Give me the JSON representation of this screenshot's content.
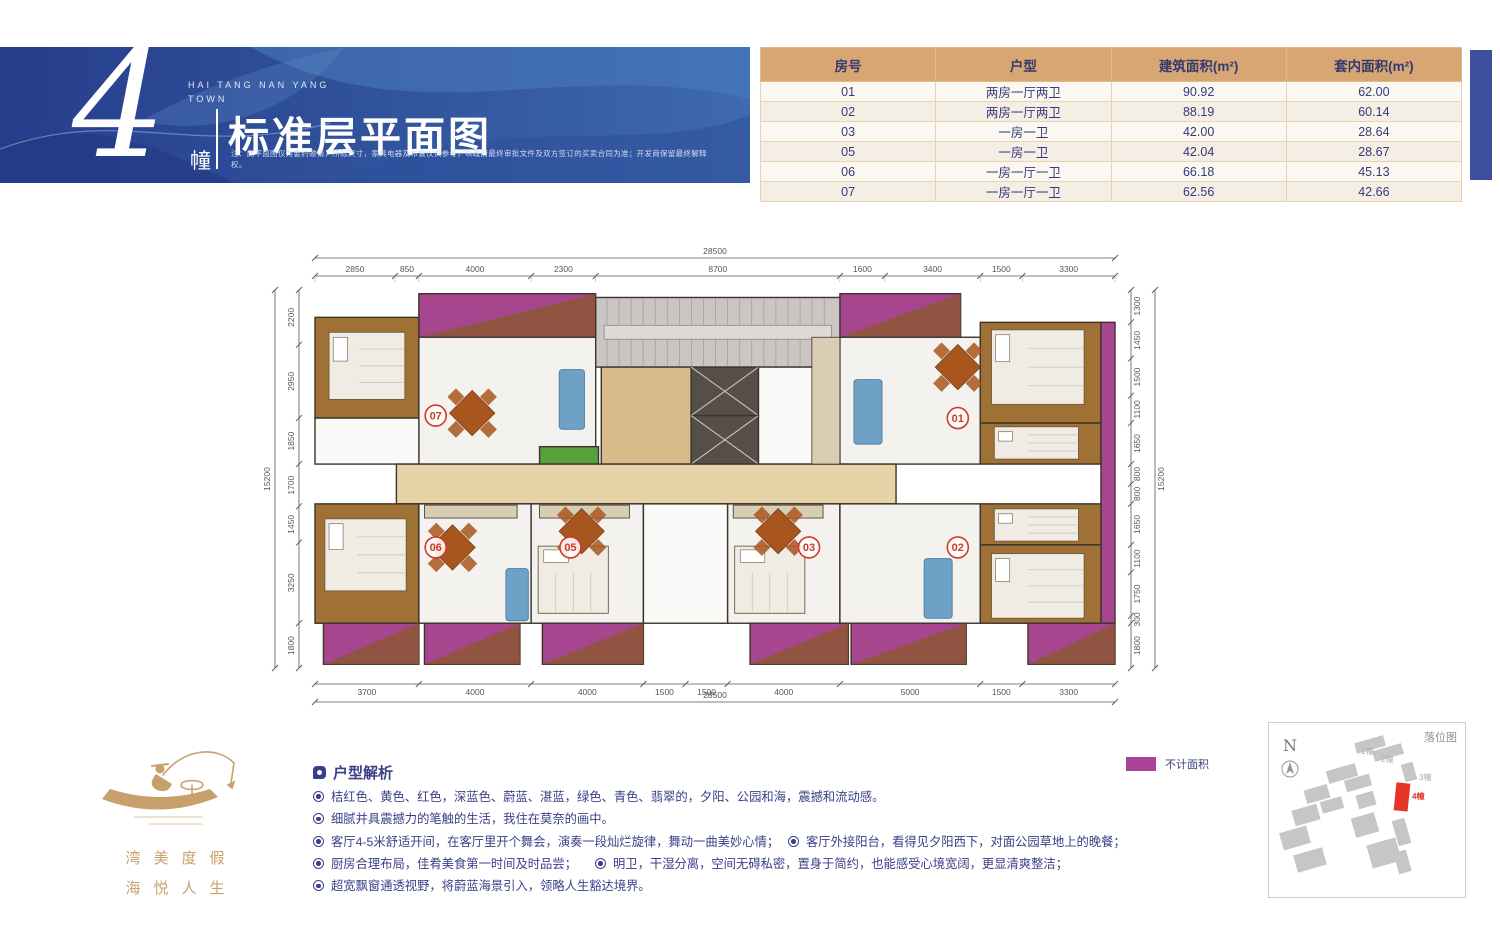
{
  "banner": {
    "building_number": "4",
    "building_unit": "幢",
    "project_name": "HAI TANG NAN YANG\nTOWN",
    "title": "标准层平面图",
    "disclaimer": "注：此平面图仅为要约邀请，所标尺寸，家具电器及布置仅供参考，以政府最终审批文件及双方签订的买卖合同为准；开发商保留最终解释权。"
  },
  "table": {
    "columns": [
      "房号",
      "户型",
      "建筑面积(m²)",
      "套内面积(m²)"
    ],
    "rows": [
      [
        "01",
        "两房一厅两卫",
        "90.92",
        "62.00"
      ],
      [
        "02",
        "两房一厅两卫",
        "88.19",
        "60.14"
      ],
      [
        "03",
        "一房一卫",
        "42.00",
        "28.64"
      ],
      [
        "05",
        "一房一卫",
        "42.04",
        "28.67"
      ],
      [
        "06",
        "一房一厅一卫",
        "66.18",
        "45.13"
      ],
      [
        "07",
        "一房一厅一卫",
        "62.56",
        "42.66"
      ]
    ]
  },
  "plan": {
    "overall_width_label": "28500",
    "overall_height_label": "15200",
    "dims_top": [
      2850,
      850,
      4000,
      2300,
      8700,
      1600,
      3400,
      1500,
      3300
    ],
    "dims_bottom": [
      3700,
      4000,
      4000,
      1500,
      1500,
      4000,
      5000,
      1500,
      3300
    ],
    "dims_left": [
      2200,
      2950,
      1850,
      1700,
      1450,
      3250,
      1800
    ],
    "dims_right": [
      1300,
      1450,
      1500,
      1100,
      1650,
      800,
      800,
      1650,
      1100,
      1750,
      300,
      1800
    ],
    "unit_labels": [
      {
        "id": "07",
        "x": 4300,
        "y": 5050
      },
      {
        "id": "01",
        "x": 22900,
        "y": 5150
      },
      {
        "id": "06",
        "x": 4300,
        "y": 10350
      },
      {
        "id": "05",
        "x": 9100,
        "y": 10350
      },
      {
        "id": "03",
        "x": 17600,
        "y": 10350
      },
      {
        "id": "02",
        "x": 22900,
        "y": 10350
      }
    ],
    "rooms": [
      {
        "x": 3700,
        "y": 150,
        "w": 6300,
        "h": 1750,
        "t": "balcony"
      },
      {
        "x": 18700,
        "y": 150,
        "w": 4300,
        "h": 1750,
        "t": "balcony"
      },
      {
        "x": 0,
        "y": 1100,
        "w": 3700,
        "h": 4050,
        "t": "bedroom"
      },
      {
        "x": 3700,
        "y": 1900,
        "w": 6300,
        "h": 5100,
        "t": "living"
      },
      {
        "x": 0,
        "y": 5150,
        "w": 3700,
        "h": 1850,
        "t": "bath"
      },
      {
        "x": 10000,
        "y": 300,
        "w": 8700,
        "h": 2800,
        "t": "stairs"
      },
      {
        "x": 10200,
        "y": 3100,
        "w": 3200,
        "h": 3900,
        "t": "lobby"
      },
      {
        "x": 13400,
        "y": 3100,
        "w": 2400,
        "h": 1950,
        "t": "elevator"
      },
      {
        "x": 13400,
        "y": 5050,
        "w": 2400,
        "h": 1950,
        "t": "elevator"
      },
      {
        "x": 15800,
        "y": 3100,
        "w": 2900,
        "h": 3900,
        "t": "bath"
      },
      {
        "x": 18700,
        "y": 1900,
        "w": 5000,
        "h": 5100,
        "t": "living"
      },
      {
        "x": 23700,
        "y": 1300,
        "w": 4300,
        "h": 4050,
        "t": "bedroom"
      },
      {
        "x": 23700,
        "y": 5350,
        "w": 4300,
        "h": 1650,
        "t": "bedroom"
      },
      {
        "x": 28000,
        "y": 1300,
        "w": 500,
        "h": 12100,
        "t": "balcony"
      },
      {
        "x": 8000,
        "y": 6300,
        "w": 2100,
        "h": 700,
        "t": "planter"
      },
      {
        "x": 2900,
        "y": 7000,
        "w": 17800,
        "h": 1600,
        "t": "corridor"
      },
      {
        "x": 0,
        "y": 8600,
        "w": 3700,
        "h": 4800,
        "t": "bedroom"
      },
      {
        "x": 3700,
        "y": 8600,
        "w": 4000,
        "h": 4800,
        "t": "living"
      },
      {
        "x": 7700,
        "y": 8600,
        "w": 4000,
        "h": 4800,
        "t": "living"
      },
      {
        "x": 11700,
        "y": 8600,
        "w": 3000,
        "h": 4800,
        "t": "bath"
      },
      {
        "x": 14700,
        "y": 8600,
        "w": 4000,
        "h": 4800,
        "t": "living"
      },
      {
        "x": 18700,
        "y": 8600,
        "w": 5000,
        "h": 4800,
        "t": "living"
      },
      {
        "x": 23700,
        "y": 8600,
        "w": 4300,
        "h": 1650,
        "t": "bedroom"
      },
      {
        "x": 23700,
        "y": 10250,
        "w": 4300,
        "h": 3150,
        "t": "bedroom"
      },
      {
        "x": 300,
        "y": 13400,
        "w": 3400,
        "h": 1650,
        "t": "balcony"
      },
      {
        "x": 3900,
        "y": 13400,
        "w": 3400,
        "h": 1650,
        "t": "balcony"
      },
      {
        "x": 8100,
        "y": 13400,
        "w": 3600,
        "h": 1650,
        "t": "balcony"
      },
      {
        "x": 15500,
        "y": 13400,
        "w": 3500,
        "h": 1650,
        "t": "balcony"
      },
      {
        "x": 19100,
        "y": 13400,
        "w": 4100,
        "h": 1650,
        "t": "balcony"
      },
      {
        "x": 25400,
        "y": 13400,
        "w": 3100,
        "h": 1650,
        "t": "balcony"
      },
      {
        "x": 3900,
        "y": 8650,
        "w": 3300,
        "h": 520,
        "t": "counter"
      },
      {
        "x": 8000,
        "y": 8650,
        "w": 3200,
        "h": 520,
        "t": "counter"
      },
      {
        "x": 14900,
        "y": 8650,
        "w": 3200,
        "h": 520,
        "t": "counter"
      },
      {
        "x": 17700,
        "y": 1900,
        "w": 1000,
        "h": 5100,
        "t": "counter"
      }
    ],
    "beds": [
      {
        "x": 500,
        "y": 1700,
        "w": 2700,
        "h": 2700
      },
      {
        "x": 350,
        "y": 9200,
        "w": 2900,
        "h": 2900
      },
      {
        "x": 24100,
        "y": 1600,
        "w": 3300,
        "h": 3000
      },
      {
        "x": 24200,
        "y": 5500,
        "w": 3000,
        "h": 1300
      },
      {
        "x": 24200,
        "y": 8800,
        "w": 3000,
        "h": 1300
      },
      {
        "x": 24100,
        "y": 10600,
        "w": 3300,
        "h": 2600
      },
      {
        "x": 7950,
        "y": 10300,
        "w": 2500,
        "h": 2700
      },
      {
        "x": 14950,
        "y": 10300,
        "w": 2500,
        "h": 2700
      }
    ],
    "tables": [
      {
        "x": 5600,
        "y": 4950
      },
      {
        "x": 4900,
        "y": 10350
      },
      {
        "x": 9500,
        "y": 9700
      },
      {
        "x": 16500,
        "y": 9700
      },
      {
        "x": 22900,
        "y": 3100
      }
    ],
    "sofas": [
      {
        "x": 8700,
        "y": 3200,
        "w": 900,
        "h": 2400
      },
      {
        "x": 19200,
        "y": 3600,
        "w": 1000,
        "h": 2600
      },
      {
        "x": 6800,
        "y": 11200,
        "w": 800,
        "h": 2100
      },
      {
        "x": 21700,
        "y": 10800,
        "w": 1000,
        "h": 2400
      }
    ],
    "colors": {
      "wall": "#3b332c",
      "balcony": "#a8458f",
      "balcony_wood": "#8a5a28",
      "bedroom": "#a07134",
      "living": "#f4f2ee",
      "bath": "#fafaf8",
      "corridor": "#e6d3a8",
      "lobby": "#d8bb8b",
      "stairs": "#cbc5c3",
      "elevator": "#564e48",
      "planter": "#58a03c",
      "counter": "#d9cdb4",
      "label": "#d03928",
      "dim": "#555555",
      "bed": "#f0ece3",
      "sofa": "#6fa0c6",
      "table": "#a9561e"
    }
  },
  "legend": {
    "label": "不计面积",
    "color": "#a94397"
  },
  "logo": {
    "line1": "湾美度假",
    "line2": "海悦人生"
  },
  "analysis": {
    "heading": "户型解析",
    "rows": [
      [
        {
          "text": "桔红色、黄色、红色，深蓝色、蔚蓝、湛蓝，绿色、青色、翡翠的，夕阳、公园和海，震撼和流动感。"
        }
      ],
      [
        {
          "text": "细腻并具震撼力的笔触的生活，我住在莫奈的画中。"
        }
      ],
      [
        {
          "text": "客厅4-5米舒适开间，在客厅里开个舞会，演奏一段灿烂旋律，舞动一曲美妙心情；",
          "w": "475px"
        },
        {
          "text": "客厅外接阳台，看得见夕阳西下，对面公园草地上的晚餐；"
        }
      ],
      [
        {
          "text": "厨房合理布局，佳肴美食第一时间及时品尝；",
          "w": "282px"
        },
        {
          "text": "明卫，干湿分离，空间无碍私密，置身于简约，也能感受心境宽阔，更显清爽整洁；"
        }
      ],
      [
        {
          "text": "超宽飘窗通透视野，将蔚蓝海景引入，领略人生豁达境界。"
        }
      ]
    ]
  },
  "siteplan": {
    "title": "落位图",
    "north_label": "N",
    "building_labels": [
      {
        "id": "1幢",
        "x": 92,
        "y": 31,
        "color": "#aaaaaa"
      },
      {
        "id": "2幢",
        "x": 112,
        "y": 39,
        "color": "#aaaaaa"
      },
      {
        "id": "3幢",
        "x": 150,
        "y": 57,
        "color": "#aaaaaa"
      },
      {
        "id": "4幢",
        "x": 143,
        "y": 76,
        "color": "#e63427"
      }
    ]
  }
}
